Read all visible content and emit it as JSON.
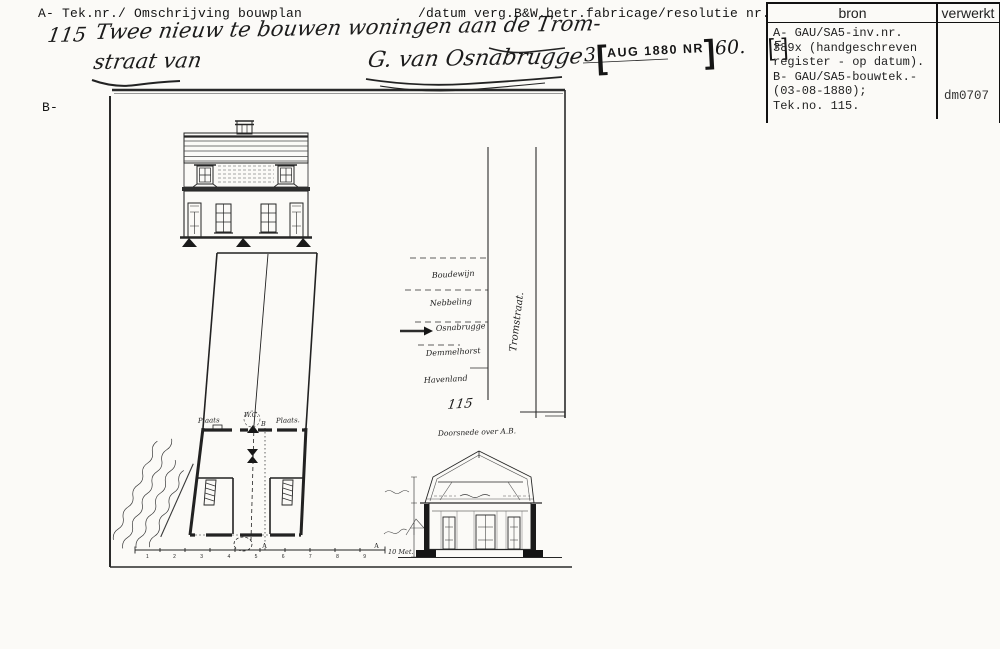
{
  "header": {
    "field_label_left": "A- Tek.nr./ Omschrijving bouwplan",
    "field_label_right": "/datum verg.B&W.betr.fabricage/resolutie nr.",
    "section_label_b": "B-",
    "tek_nr": "115",
    "description_line1": "Twee nieuw te bouwen woningen aan de Trom-",
    "description_line2": "straat van",
    "applicant_signature": "G. van Osnabrugge",
    "date_stamp": {
      "day": "3",
      "stamp_text": "AUG 1880 NR",
      "number": "60.",
      "code": "F"
    }
  },
  "register_table": {
    "col_bron": "bron",
    "col_verwerkt": "verwerkt",
    "bron_lines": [
      "A- GAU/SA5-inv.nr.",
      "389x (handgeschreven",
      "register - op datum).",
      "B- GAU/SA5-bouwtek.-",
      "(03-08-1880);",
      "Tek.no. 115."
    ],
    "verwerkt_value": "dm0707"
  },
  "drawing": {
    "plan": {
      "label_yard_left": "Plaats",
      "label_wc": "W.C.",
      "label_b": "B",
      "label_yard_right": "Plaats.",
      "section_marker": "A",
      "scale_numbers": "1 2 3 4 5 6 7 8 9",
      "scale_label": "10 Met."
    },
    "situation": {
      "street_name": "Tromstraat.",
      "neighbors": [
        "Boudewijn",
        "Nebbeling",
        "Osnabrugge",
        "Demmelhorst",
        "Havenland"
      ],
      "sheet_number": "115"
    },
    "section": {
      "title": "Doorsnede over A.B."
    }
  },
  "colors": {
    "ink": "#1d1d1d",
    "paper": "#fbfaf7"
  }
}
